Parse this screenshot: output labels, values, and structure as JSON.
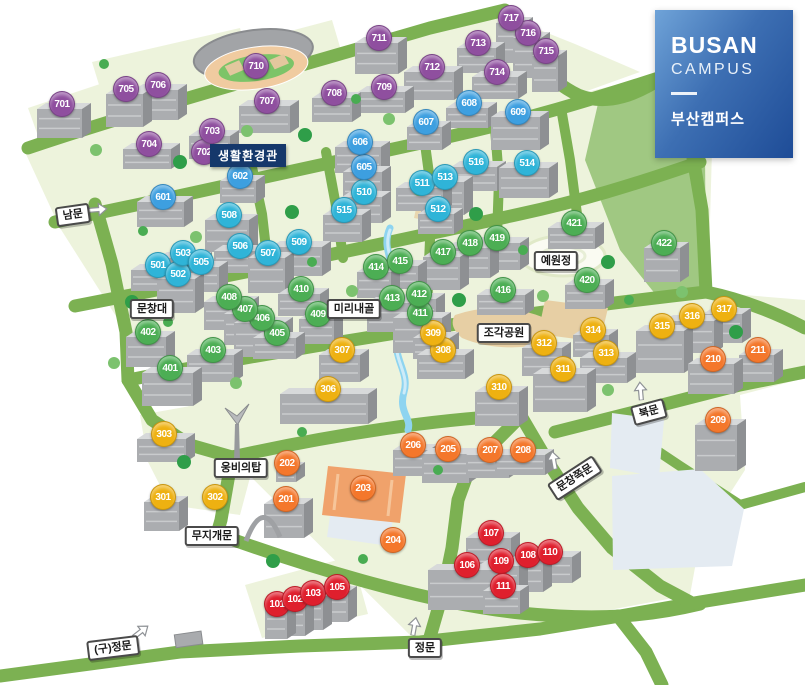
{
  "legend": {
    "title_en_line1": "BUSAN",
    "title_en_line2": "CAMPUS",
    "title_ko": "부산캠퍼스"
  },
  "tooltip": {
    "text": "생활환경관"
  },
  "palette": {
    "road": "#7CB152",
    "block": "#EDF3DC",
    "water": "#8ED4F0",
    "pond": "#E4EBF2",
    "sand": "#E7CFA4",
    "field": "#F0A26B",
    "tooltip": "#15386B",
    "series": {
      "100": "#DF1F2D",
      "200": "#F4772B",
      "300": "#EEB111",
      "400": "#4CAE54",
      "500": "#2FB4D8",
      "600": "#3D9FE0",
      "700": "#8F4F9F"
    }
  },
  "markers": [
    {
      "id": 101,
      "x": 277,
      "y": 604
    },
    {
      "id": 102,
      "x": 295,
      "y": 599
    },
    {
      "id": 103,
      "x": 313,
      "y": 593
    },
    {
      "id": 105,
      "x": 337,
      "y": 587
    },
    {
      "id": 106,
      "x": 467,
      "y": 565
    },
    {
      "id": 107,
      "x": 491,
      "y": 533
    },
    {
      "id": 108,
      "x": 528,
      "y": 555
    },
    {
      "id": 109,
      "x": 501,
      "y": 561
    },
    {
      "id": 110,
      "x": 550,
      "y": 552
    },
    {
      "id": 111,
      "x": 503,
      "y": 586
    },
    {
      "id": 201,
      "x": 286,
      "y": 499
    },
    {
      "id": 202,
      "x": 287,
      "y": 463
    },
    {
      "id": 203,
      "x": 363,
      "y": 488
    },
    {
      "id": 204,
      "x": 393,
      "y": 540
    },
    {
      "id": 205,
      "x": 448,
      "y": 449
    },
    {
      "id": 206,
      "x": 413,
      "y": 445
    },
    {
      "id": 207,
      "x": 490,
      "y": 450
    },
    {
      "id": 208,
      "x": 523,
      "y": 450
    },
    {
      "id": 209,
      "x": 718,
      "y": 420
    },
    {
      "id": 210,
      "x": 713,
      "y": 359
    },
    {
      "id": 211,
      "x": 758,
      "y": 350
    },
    {
      "id": 301,
      "x": 163,
      "y": 497
    },
    {
      "id": 302,
      "x": 215,
      "y": 497
    },
    {
      "id": 303,
      "x": 164,
      "y": 434
    },
    {
      "id": 306,
      "x": 328,
      "y": 389
    },
    {
      "id": 307,
      "x": 342,
      "y": 350
    },
    {
      "id": 308,
      "x": 443,
      "y": 350
    },
    {
      "id": 309,
      "x": 433,
      "y": 333
    },
    {
      "id": 310,
      "x": 499,
      "y": 387
    },
    {
      "id": 311,
      "x": 563,
      "y": 369
    },
    {
      "id": 312,
      "x": 544,
      "y": 343
    },
    {
      "id": 313,
      "x": 606,
      "y": 353
    },
    {
      "id": 314,
      "x": 593,
      "y": 330
    },
    {
      "id": 315,
      "x": 662,
      "y": 326
    },
    {
      "id": 316,
      "x": 692,
      "y": 316
    },
    {
      "id": 317,
      "x": 724,
      "y": 309
    },
    {
      "id": 401,
      "x": 170,
      "y": 368
    },
    {
      "id": 402,
      "x": 148,
      "y": 332
    },
    {
      "id": 403,
      "x": 213,
      "y": 350
    },
    {
      "id": 405,
      "x": 277,
      "y": 333
    },
    {
      "id": 406,
      "x": 262,
      "y": 318
    },
    {
      "id": 407,
      "x": 245,
      "y": 309
    },
    {
      "id": 408,
      "x": 229,
      "y": 297
    },
    {
      "id": 409,
      "x": 318,
      "y": 314
    },
    {
      "id": 410,
      "x": 301,
      "y": 289
    },
    {
      "id": 411,
      "x": 420,
      "y": 313
    },
    {
      "id": 412,
      "x": 419,
      "y": 294
    },
    {
      "id": 413,
      "x": 392,
      "y": 298
    },
    {
      "id": 414,
      "x": 376,
      "y": 267
    },
    {
      "id": 415,
      "x": 400,
      "y": 261
    },
    {
      "id": 416,
      "x": 503,
      "y": 290
    },
    {
      "id": 417,
      "x": 443,
      "y": 252
    },
    {
      "id": 418,
      "x": 470,
      "y": 243
    },
    {
      "id": 419,
      "x": 497,
      "y": 238
    },
    {
      "id": 420,
      "x": 587,
      "y": 280
    },
    {
      "id": 421,
      "x": 574,
      "y": 223
    },
    {
      "id": 422,
      "x": 664,
      "y": 243
    },
    {
      "id": 501,
      "x": 158,
      "y": 265
    },
    {
      "id": 502,
      "x": 178,
      "y": 274
    },
    {
      "id": 503,
      "x": 183,
      "y": 253
    },
    {
      "id": 505,
      "x": 201,
      "y": 262
    },
    {
      "id": 506,
      "x": 240,
      "y": 246
    },
    {
      "id": 507,
      "x": 268,
      "y": 253
    },
    {
      "id": 508,
      "x": 229,
      "y": 215
    },
    {
      "id": 509,
      "x": 299,
      "y": 242
    },
    {
      "id": 510,
      "x": 364,
      "y": 192
    },
    {
      "id": 511,
      "x": 422,
      "y": 183
    },
    {
      "id": 512,
      "x": 438,
      "y": 209
    },
    {
      "id": 513,
      "x": 445,
      "y": 177
    },
    {
      "id": 514,
      "x": 527,
      "y": 163
    },
    {
      "id": 515,
      "x": 344,
      "y": 210
    },
    {
      "id": 516,
      "x": 476,
      "y": 162
    },
    {
      "id": 601,
      "x": 163,
      "y": 197
    },
    {
      "id": 602,
      "x": 240,
      "y": 176
    },
    {
      "id": 605,
      "x": 364,
      "y": 167
    },
    {
      "id": 606,
      "x": 360,
      "y": 142
    },
    {
      "id": 607,
      "x": 426,
      "y": 122
    },
    {
      "id": 608,
      "x": 469,
      "y": 103
    },
    {
      "id": 609,
      "x": 518,
      "y": 112
    },
    {
      "id": 701,
      "x": 62,
      "y": 104
    },
    {
      "id": 702,
      "x": 204,
      "y": 152
    },
    {
      "id": 703,
      "x": 212,
      "y": 131
    },
    {
      "id": 704,
      "x": 149,
      "y": 144
    },
    {
      "id": 705,
      "x": 126,
      "y": 89
    },
    {
      "id": 706,
      "x": 158,
      "y": 85
    },
    {
      "id": 707,
      "x": 267,
      "y": 101
    },
    {
      "id": 708,
      "x": 334,
      "y": 93
    },
    {
      "id": 709,
      "x": 384,
      "y": 87
    },
    {
      "id": 710,
      "x": 256,
      "y": 66
    },
    {
      "id": 711,
      "x": 379,
      "y": 38
    },
    {
      "id": 712,
      "x": 432,
      "y": 67
    },
    {
      "id": 713,
      "x": 478,
      "y": 43
    },
    {
      "id": 714,
      "x": 497,
      "y": 72
    },
    {
      "id": 715,
      "x": 546,
      "y": 51
    },
    {
      "id": 716,
      "x": 528,
      "y": 33
    },
    {
      "id": 717,
      "x": 511,
      "y": 18
    }
  ],
  "labels": [
    {
      "key": "south-gate",
      "text": "남문",
      "x": 73,
      "y": 215,
      "rot": -8
    },
    {
      "key": "munchangdae",
      "text": "문창대",
      "x": 152,
      "y": 309,
      "rot": 0
    },
    {
      "key": "mirinae-valley",
      "text": "미리내골",
      "x": 354,
      "y": 309,
      "rot": 0
    },
    {
      "key": "sculpture-park",
      "text": "조각공원",
      "x": 504,
      "y": 333,
      "rot": 0
    },
    {
      "key": "yewonjeong",
      "text": "예원정",
      "x": 556,
      "y": 261,
      "rot": 0
    },
    {
      "key": "ungbi-tower",
      "text": "웅비의탑",
      "x": 241,
      "y": 468,
      "rot": 0
    },
    {
      "key": "rainbow-gate",
      "text": "무지개문",
      "x": 212,
      "y": 536,
      "rot": 0
    },
    {
      "key": "old-main-gate",
      "text": "(구)정문",
      "x": 113,
      "y": 648,
      "rot": -7
    },
    {
      "key": "main-gate",
      "text": "정문",
      "x": 425,
      "y": 648,
      "rot": 0
    },
    {
      "key": "north-gate",
      "text": "북문",
      "x": 649,
      "y": 412,
      "rot": -15
    },
    {
      "key": "munchang-side-gate",
      "text": "문창쪽문",
      "x": 575,
      "y": 478,
      "rot": -33
    }
  ],
  "arrows": [
    {
      "x": 99,
      "y": 212,
      "rot": -5
    },
    {
      "x": 143,
      "y": 633,
      "rot": -38
    },
    {
      "x": 417,
      "y": 626,
      "rot": -80
    },
    {
      "x": 643,
      "y": 390,
      "rot": -95
    },
    {
      "x": 556,
      "y": 459,
      "rot": -100
    }
  ]
}
